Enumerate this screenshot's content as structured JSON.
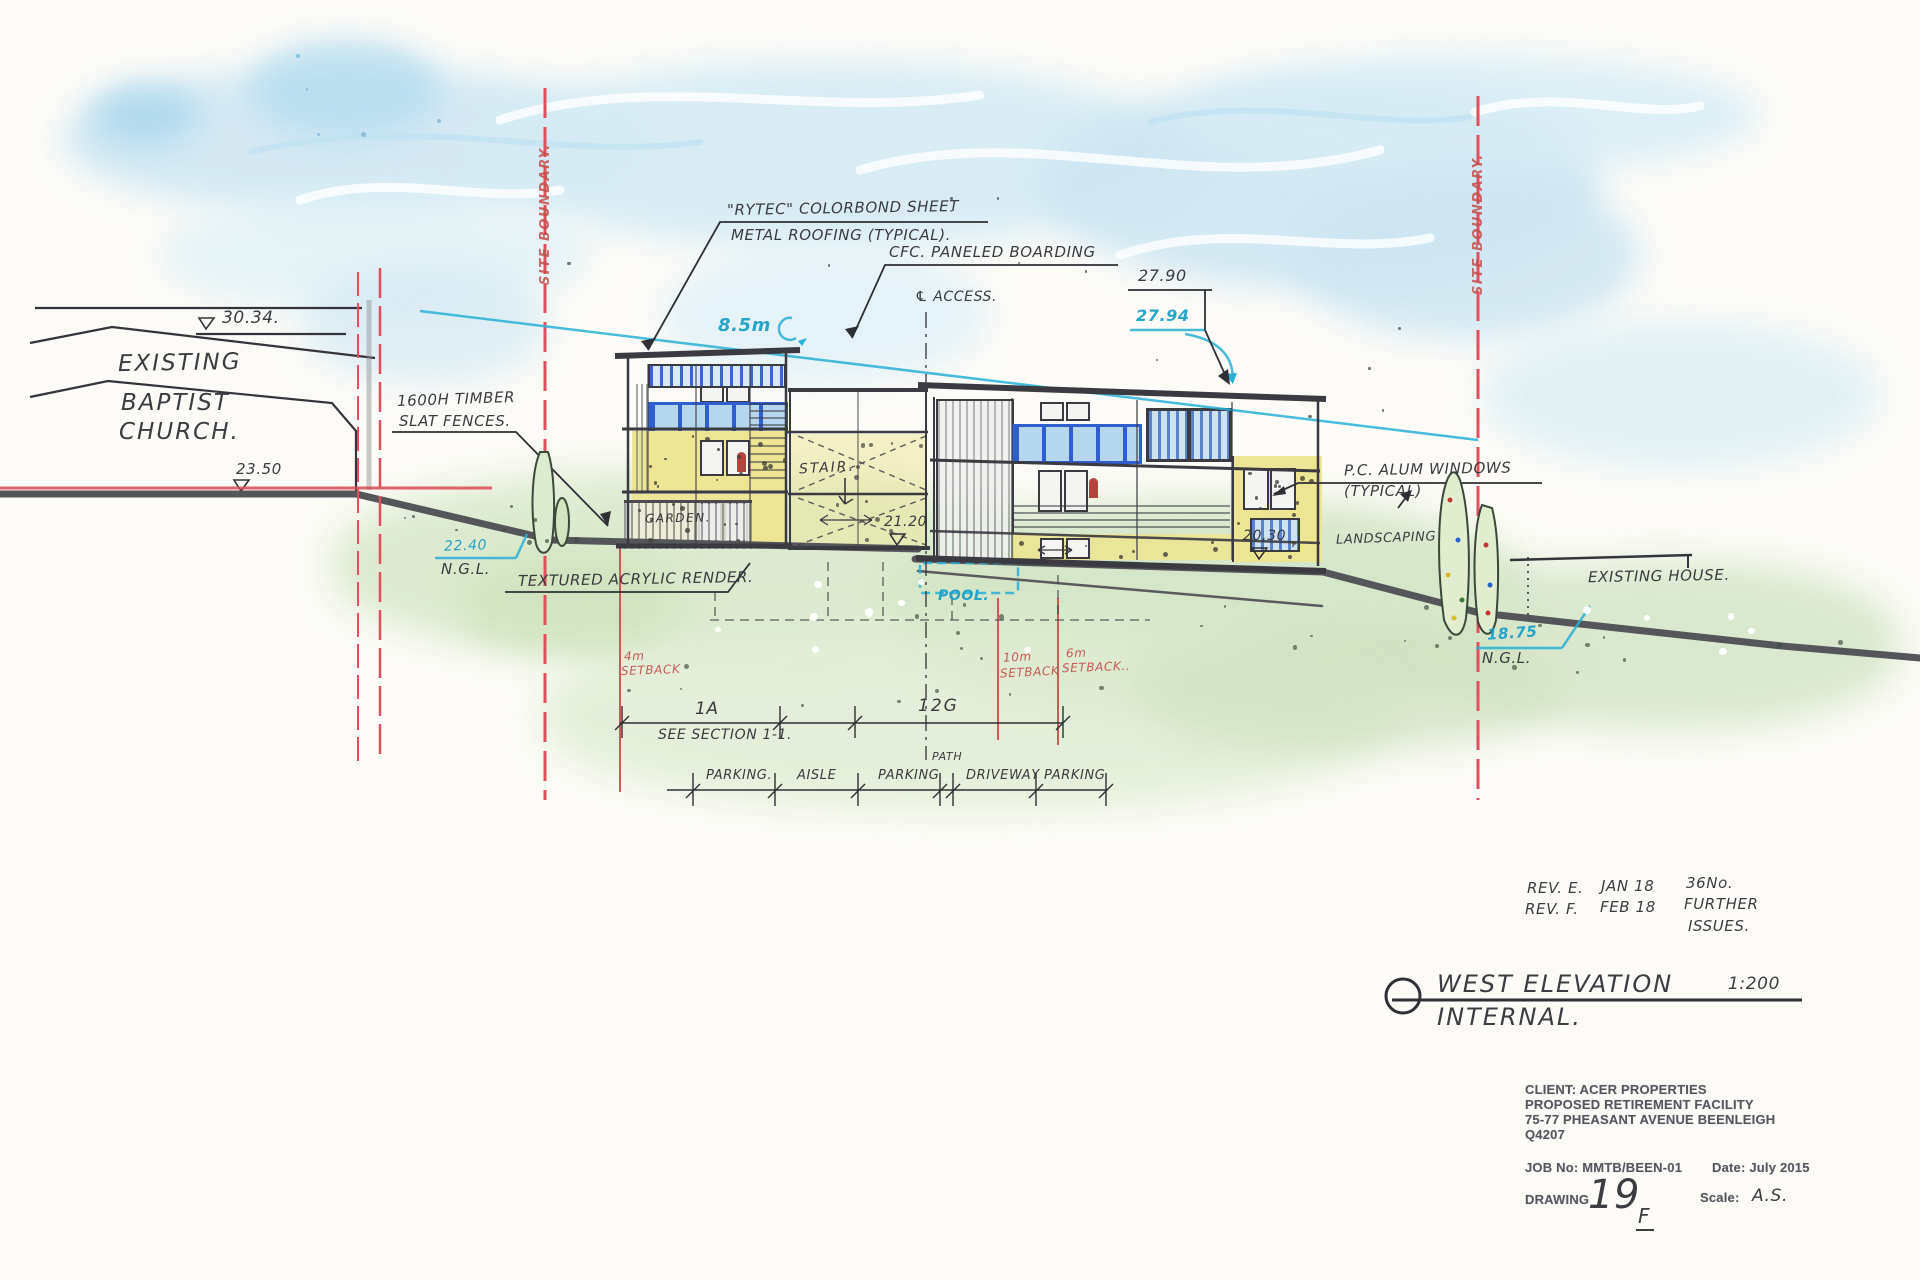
{
  "boundaries": {
    "left_label": "SITE BOUNDARY.",
    "right_label": "SITE BOUNDARY."
  },
  "church": {
    "line1": "EXISTING",
    "line2": "BAPTIST",
    "line3": "CHURCH.",
    "ridge_level": "30.34.",
    "ground_level": "23.50"
  },
  "site": {
    "ngl_left_value": "22.40",
    "ngl_left_label": "N.G.L.",
    "ngl_right_value": "18.75",
    "ngl_right_label": "N.G.L.",
    "height_line": "8.5m",
    "setback_left_1": "4m",
    "setback_left_2": "SETBACK",
    "setback_mid_1": "10m",
    "setback_mid_2": "SETBACK",
    "setback_right_1": "6m",
    "setback_right_2": "SETBACK.."
  },
  "buildings": {
    "roof_note_1": "\"RYTEC\" COLORBOND SHEET",
    "roof_note_2": "METAL ROOFING (TYPICAL).",
    "boarding_note": "CFC. PANELED BOARDING",
    "access_note": "℄ ACCESS.",
    "fence_note_1": "1600H TIMBER",
    "fence_note_2": "SLAT FENCES.",
    "render_note": "TEXTURED ACRYLIC RENDER.",
    "windows_note_1": "P.C. ALUM WINDOWS",
    "windows_note_2": "(TYPICAL)",
    "landscaping_note": "LANDSCAPING",
    "pool_label": "POOL.",
    "stair_label": "STAIR.",
    "garden_label": "GARDEN.",
    "level_2790": "27.90",
    "level_2794": "27.94",
    "level_2120": "21.20",
    "level_2030": "20.30"
  },
  "neighbor": {
    "house_label": "EXISTING HOUSE."
  },
  "dimensions": {
    "seg1": "1A",
    "seg2": "12G",
    "section_note": "SEE SECTION 1-1.",
    "parking": [
      "PARKING.",
      "AISLE",
      "PARKING",
      "PATH",
      "DRIVEWAY",
      "PARKING"
    ]
  },
  "revisions": [
    {
      "rev": "REV. E.",
      "date": "JAN 18",
      "note": "36No."
    },
    {
      "rev": "REV. F.",
      "date": "FEB 18",
      "note": "FURTHER",
      "note2": "ISSUES."
    }
  ],
  "title": {
    "name": "WEST ELEVATION",
    "subtitle": "INTERNAL.",
    "scale": "1:200"
  },
  "title_block": {
    "client": "CLIENT: ACER PROPERTIES",
    "project": "PROPOSED RETIREMENT FACILITY",
    "address": "75-77 PHEASANT AVENUE BEENLEIGH",
    "postcode": "Q4207",
    "job": "JOB No: MMTB/BEEN-01",
    "date": "Date: July 2015",
    "drawing_label": "DRAWING",
    "drawing_number": "19",
    "drawing_suffix": "F",
    "scale_label": "Scale:",
    "scale_value": "A.S."
  },
  "colors": {
    "boundary_red": "#df4f5d",
    "setback_red": "#c4504d",
    "ink_blue": "#189fc7",
    "ink_black": "#2e2e34",
    "render_yellow": "#ece593",
    "window_blue": "#2f5ecf",
    "ground_grey": "#55565a",
    "wash_sky": "#cfe6f2",
    "wash_green": "#d8e7cc"
  }
}
